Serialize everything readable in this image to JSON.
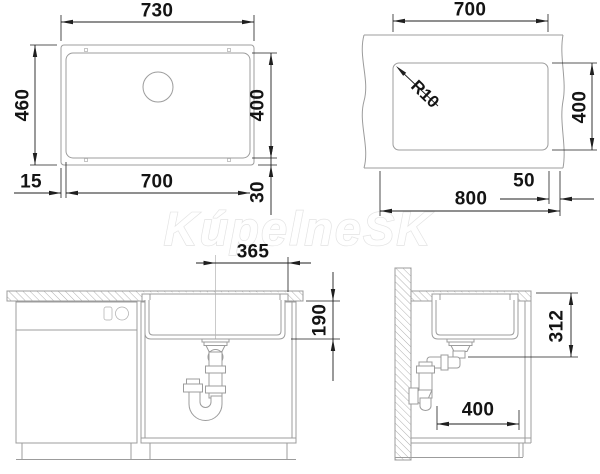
{
  "watermark": {
    "text": "KúpelneSK"
  },
  "colors": {
    "drawing_line": "#9c9c9c",
    "dimension_line": "#1f1f1f",
    "text": "#141414",
    "watermark_outline": "#e3e3e3",
    "background": "#ffffff"
  },
  "views": {
    "plan": {
      "label": "sink-top-view",
      "dims": {
        "overall_width": "730",
        "overall_depth": "460",
        "bowl_width": "700",
        "bowl_depth": "400",
        "rim_side": "15",
        "rim_edge": "30"
      }
    },
    "cutout": {
      "label": "worktop-cutout-view",
      "dims": {
        "cutout_width": "700",
        "corner_radius": "R10",
        "cutout_depth": "400",
        "cabinet_width": "800",
        "edge_distance": "50"
      }
    },
    "front": {
      "label": "installation-front-view",
      "dims": {
        "bowl_center_offset": "365",
        "bowl_depth": "190"
      }
    },
    "side": {
      "label": "installation-side-view",
      "dims": {
        "outlet_height": "312",
        "clearance_depth": "400"
      }
    }
  }
}
